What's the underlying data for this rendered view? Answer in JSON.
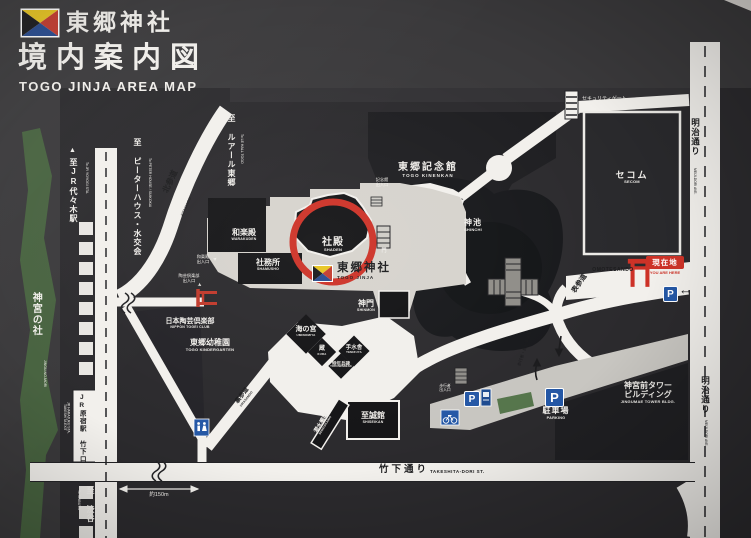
{
  "header": {
    "shrine_name": "東郷神社",
    "title": "境内案内図",
    "subtitle": "TOGO JINJA AREA MAP"
  },
  "colors": {
    "board_background": "#3a393b",
    "road_white": "#f2f0ec",
    "precinct_beige": "#d6d3cd",
    "parking_gray": "#c8c6c1",
    "forest_green": "#47623f",
    "accent_red": "#cd3227",
    "parking_blue": "#2457a5"
  },
  "map": {
    "areas": {
      "jingu_mori": {
        "jp": "神宮の社",
        "en": "JINGU-NO-MORI"
      },
      "kinenkan": {
        "jp": "東郷記念館",
        "en": "TOGO KINENKAN"
      },
      "shinchi": {
        "jp": "神池",
        "en": "SHINCHI"
      },
      "secom": {
        "jp": "セコム",
        "en": "SECOM"
      },
      "warakuden": {
        "jp": "和楽殿",
        "en": "WARAKUDEN"
      },
      "shamusho": {
        "jp": "社務所",
        "en": "SHAMUSHO"
      },
      "shaden": {
        "jp": "社殿",
        "en": "SHADEN"
      },
      "togo_jinja": {
        "jp": "東郷神社",
        "en": "TOGO JINJA"
      },
      "shinmon": {
        "jp": "神門",
        "en": "SHINMON"
      },
      "uminomiya": {
        "jp": "海の宮",
        "en": "UMINOMIYA"
      },
      "kura": {
        "jp": "蔵",
        "en": "KURA"
      },
      "temizuya": {
        "jp": "手水舎",
        "en": "TEMIZUYA"
      },
      "tokunenhei": {
        "jp": "特年兵碑",
        "en": "TOKUNENHEIHI"
      },
      "sensuikan": {
        "jp": "潜水艦碑",
        "en": "SENSUIKANHI"
      },
      "shiseikan": {
        "jp": "至誠館",
        "en": "SHISEIKAN"
      },
      "kindergarten": {
        "jp": "東郷幼稚園",
        "en": "TOGO KINDERGARTEN"
      },
      "togei_club": {
        "jp": "日本陶芸倶楽部",
        "en": "NIPPON TOGEI CLUB"
      },
      "jingumae_tower": {
        "jp1": "神宮前タワー",
        "jp2": "ビルディング",
        "en": "JINGUMAE TOWER BLDG."
      },
      "parking": {
        "jp": "駐車場",
        "en": "PARKING"
      }
    },
    "roads": {
      "meiji_dori": {
        "jp": "明治通り",
        "en": "MEIJI-DORI AVE."
      },
      "takeshita": {
        "jp": "竹下通り",
        "en": "TAKESHITA-DORI ST."
      },
      "omotesando": {
        "jp": "表参道",
        "en": "OMOTESANDO"
      },
      "kitasando": {
        "jp": "北参道",
        "en": "KITASANDO"
      },
      "urasando": {
        "jp": "裏参道",
        "en": "URASANDO"
      },
      "walkway": {
        "jp": "歩行者・自転車通路"
      }
    },
    "destinations": {
      "yoyogi": {
        "jp": "至JR代々木駅",
        "en": "To JR YOYOGI STA."
      },
      "peter_house": {
        "jp": "至 ピーターハウス・水交会",
        "en": "To PETER HOUSE / SUIKOKAI"
      },
      "le_hall": {
        "jp": "至 ルアール東郷",
        "en": "To LE HALL TOGO"
      },
      "shibuya": {
        "jp": "至 渋谷",
        "en": "To SHIBUYA"
      }
    },
    "station": {
      "jp": "JR原宿駅 竹下口",
      "en1": "JR HARAJUKU STA.",
      "en2": "TAKESHITA EXIT"
    },
    "markers": {
      "genzaichi": {
        "jp": "現在地",
        "en": "YOU ARE HERE"
      },
      "security_gate": {
        "jp": "セキュリティゲート"
      },
      "kinenkan_entrance": {
        "jp1": "記念館",
        "jp2": "出入口"
      },
      "warakuden_entrance": {
        "jp1": "和楽殿",
        "jp2": "出入口"
      },
      "togei_entrance": {
        "jp1": "陶芸倶楽部",
        "jp2": "出入口"
      },
      "pedestrian_entrance": {
        "jp1": "歩行者",
        "jp2": "出入口"
      },
      "mon": {
        "jp": "門"
      },
      "distance": {
        "text": "約150m"
      },
      "parking_letter": "P",
      "arrow_left": "←",
      "arrow_down": "↓",
      "arrow_up": "↑",
      "tri_up": "▲",
      "pointer": "➤"
    }
  }
}
